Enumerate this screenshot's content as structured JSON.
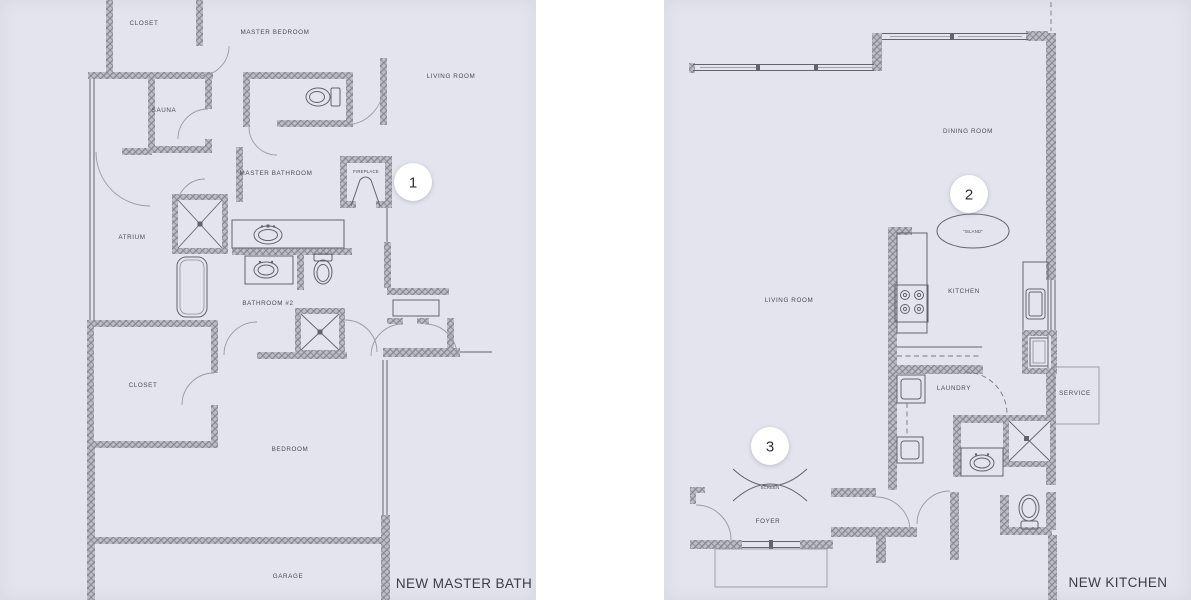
{
  "colors": {
    "paper": "#e3e4ed",
    "gutter": "#ffffff",
    "wall_base": "#bdbdc7",
    "wall_line": "#7f7f8a",
    "line": "#63636e",
    "door": "#9a9aa6",
    "text": "#4b4b55",
    "title": "#3c3c44",
    "marker_bg": "#ffffff",
    "marker_text": "#2f2f36"
  },
  "left_plan": {
    "title": "NEW MASTER BATH",
    "marker": "1",
    "labels": {
      "closet_top": "CLOSET",
      "master_bedroom": "MASTER BEDROOM",
      "living_room": "LIVING ROOM",
      "sauna": "SAUNA",
      "master_bathroom": "MASTER BATHROOM",
      "fireplace": "FIREPLACE",
      "atrium": "ATRIUM",
      "bathroom_2": "BATHROOM #2",
      "closet_bottom": "CLOSET",
      "bedroom": "BEDROOM",
      "garage": "GARAGE"
    }
  },
  "right_plan": {
    "title": "NEW KITCHEN",
    "markers": {
      "kitchen": "2",
      "foyer": "3"
    },
    "labels": {
      "dining_room": "DINING ROOM",
      "island": "\"ISLAND\"",
      "living_room": "LIVING ROOM",
      "kitchen": "KITCHEN",
      "laundry": "LAUNDRY",
      "service": "SERVICE",
      "screen": "SCREEN",
      "foyer": "FOYER"
    }
  }
}
